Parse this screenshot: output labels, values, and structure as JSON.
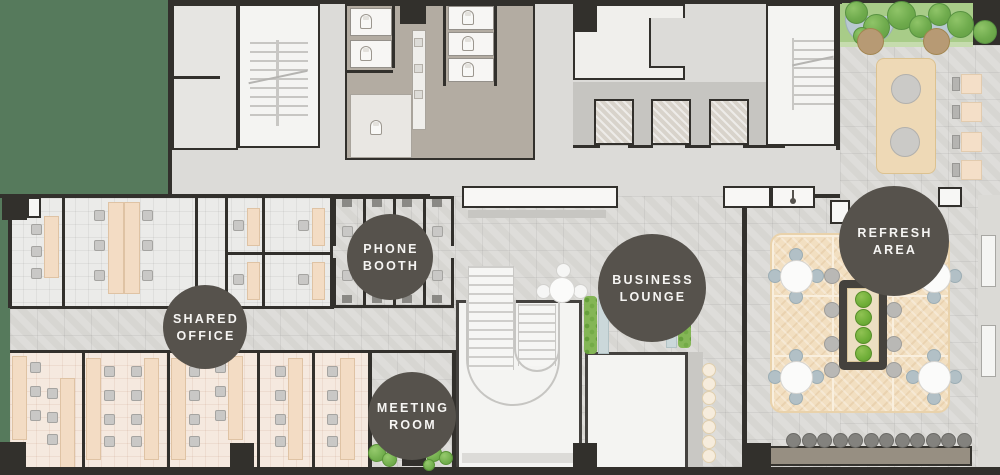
{
  "floorplan": {
    "areas": {
      "phone_booth": {
        "line1": "PHONE",
        "line2": "BOOTH"
      },
      "shared_office": {
        "line1": "SHARED",
        "line2": "OFFICE"
      },
      "business_lounge": {
        "line1": "BUSINESS",
        "line2": "LOUNGE"
      },
      "meeting_room": {
        "line1": "MEETING",
        "line2": "ROOM"
      },
      "refresh_area": {
        "line1": "REFRESH",
        "line2": "AREA"
      }
    },
    "colors": {
      "outdoor_green": "#567a5c",
      "lawn_green": "#a8cc88",
      "tree_green": "#6fab4d",
      "plant_green": "#6fae38",
      "label_circle": "#56524c",
      "label_text": "#f6f5f3",
      "wall_dark": "#32302c",
      "desk_peach": "#f3dcc4",
      "office_tile": "#ebebe9",
      "warm_tile": "#f5e9df",
      "stone_tile": "#d7d6d2",
      "washroom_taupe": "#b3aca2",
      "corridor_gray": "#dcdbd8",
      "wood_deck": "#f2dfc1",
      "bench_brown": "#978f82",
      "canopy_blue": "#b9c9d1",
      "terrace_table_brown": "#b79a74",
      "bench_blue": "#cbd8da"
    }
  }
}
